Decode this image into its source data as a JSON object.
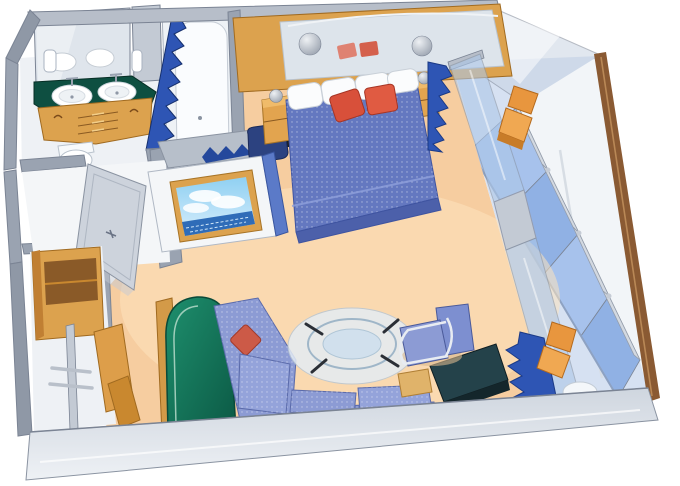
{
  "scene": {
    "title": "Cruise-ship suite floor plan, 3D cutaway rendering",
    "view": "aerial cutaway perspective, no text labels",
    "background": "#ffffff"
  },
  "palette": {
    "wall": "#aab3c0",
    "wall_light": "#c6cdd7",
    "wall_dark": "#8f98a6",
    "wood": "#dca24e",
    "wood_dark": "#c07f33",
    "carpet": "#f6cda0",
    "carpet_light": "#fde3bd",
    "bedspread": "#6478c0",
    "bedspread_dark": "#4c60aa",
    "sofa": "#8c9bd4",
    "sofa_light": "#94a3da",
    "pillow_red": "#d8503a",
    "curtain_blue": "#2e55b4",
    "counter_green": "#0e4f41",
    "chair_green": "#17876b",
    "lounger_orange": "#e8963e",
    "balcony_glass": "#a7c2ec",
    "door_glass": "#adc7e8",
    "divider_brown": "#8a5a33",
    "desk_dark": "#24424a",
    "tv_sky": "#8fd0f2",
    "tv_sea": "#2f6cb8",
    "tub_white": "#fafcfe"
  },
  "rooms": {
    "bathroom": {
      "label": "Bathroom with double vanity, mirror and bathtub",
      "items": [
        "mirror",
        "twin sinks on green counter",
        "wood vanity drawers",
        "toilet",
        "bathtub",
        "blue pleated shower curtain",
        "wall dispensers"
      ]
    },
    "entry": {
      "label": "Entry hall with open cabin door",
      "items": [
        "open door leaf"
      ]
    },
    "closet": {
      "label": "Walk-in closet with open wood doors",
      "items": [
        "wood cabinet",
        "hanging rods",
        "open doors"
      ]
    },
    "bedroom": {
      "label": "Bedroom with queen bed and mirrored headboard",
      "items": [
        "blue quilted bedspread",
        "white pillows",
        "two red accent pillows",
        "mirrored headboard wall in wood frame",
        "two wood nightstands",
        "sphere lamps",
        "TV in wood frame on white cabinet",
        "vanity shelf with pleated valance",
        "navy stool"
      ]
    },
    "living": {
      "label": "Sitting area",
      "items": [
        "blue sectional sofa",
        "red throw pillow",
        "green high-back chair",
        "round glass coffee table",
        "blue metal-frame armchair",
        "tan side table",
        "dark corner desk"
      ]
    },
    "balcony": {
      "label": "Private balcony",
      "items": [
        "glass balustrade with rails",
        "two orange loungers",
        "round white table",
        "glass privacy screen",
        "wood divider wall",
        "sliding glass doors",
        "blue pleated curtains"
      ]
    }
  }
}
